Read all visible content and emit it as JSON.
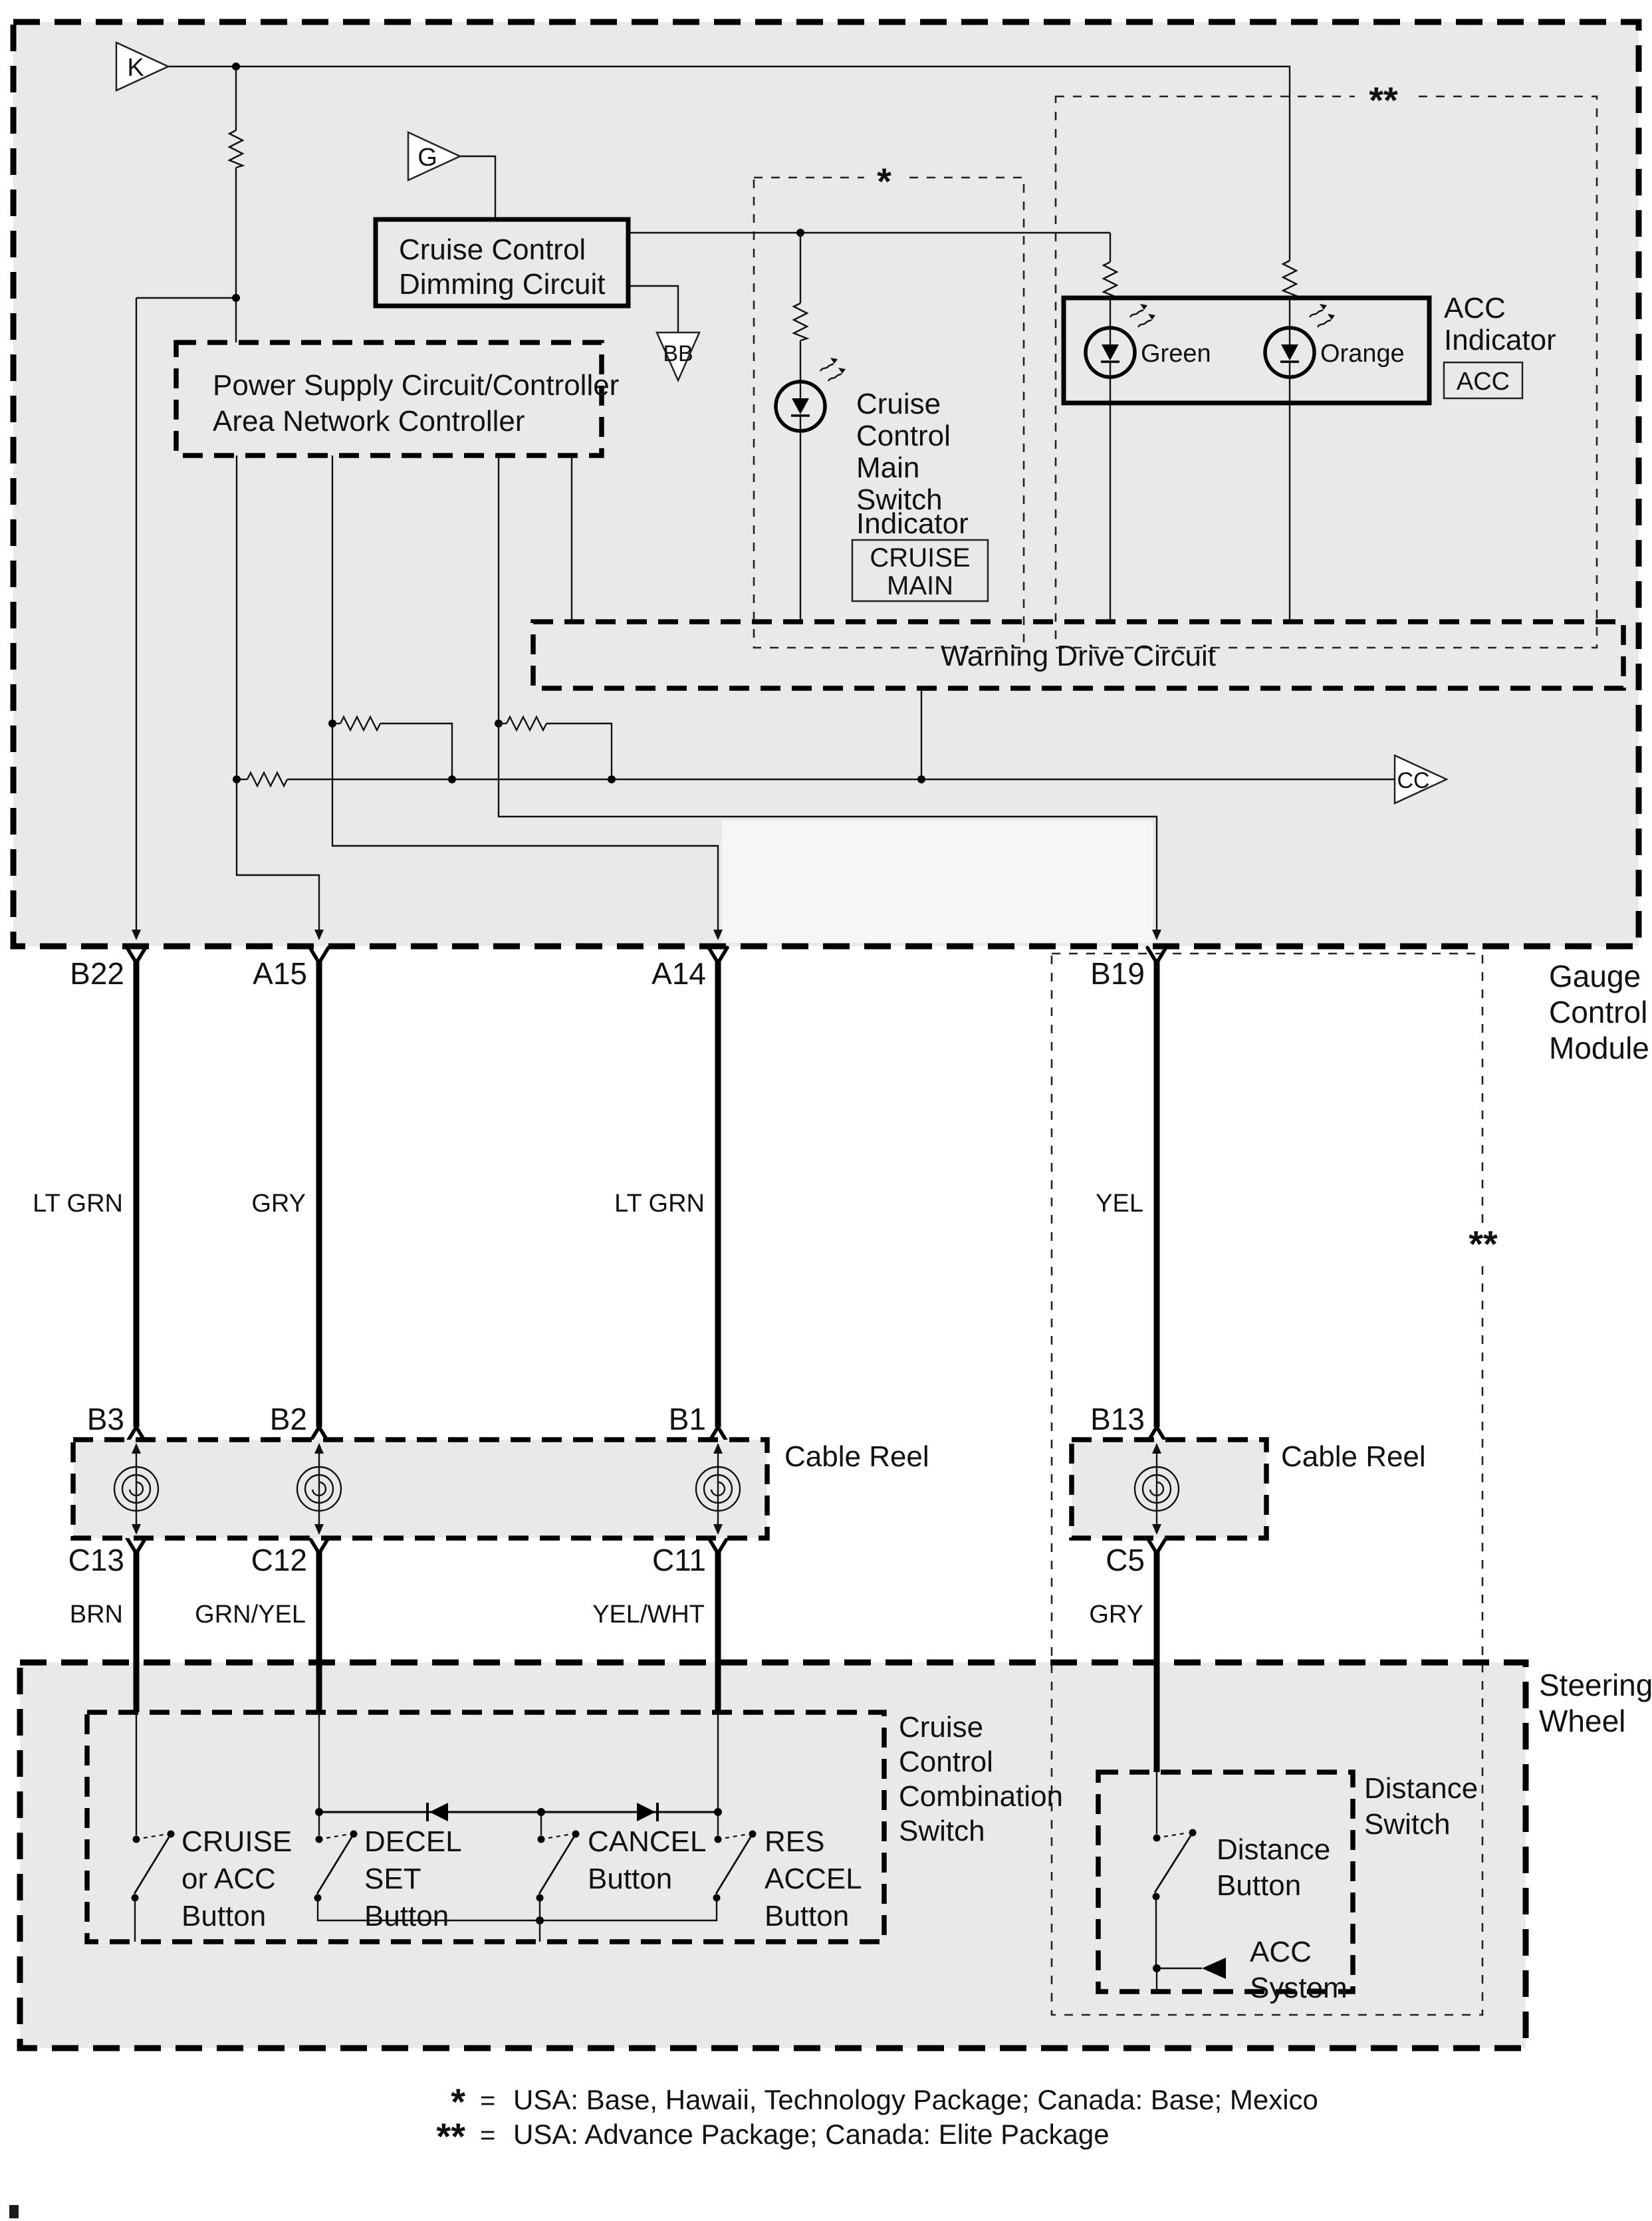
{
  "colors": {
    "module_fill": "#e9e9e9",
    "line": "#111111",
    "background": "#ffffff"
  },
  "connectors": {
    "k": "K",
    "g": "G",
    "bb": "BB",
    "cc": "CC"
  },
  "gauge": {
    "label_lines": [
      "Gauge",
      "Control",
      "Module"
    ],
    "dimming_lines": [
      "Cruise Control",
      "Dimming Circuit"
    ],
    "power_lines": [
      "Power Supply Circuit/Controller",
      "Area Network Controller"
    ],
    "warning": "Warning Drive Circuit",
    "cruise_main": {
      "label_lines": [
        "Cruise",
        "Control",
        "Main",
        "Switch",
        "Indicator"
      ],
      "badge_lines": [
        "CRUISE",
        "MAIN"
      ],
      "region_mark": "*"
    },
    "acc": {
      "label_lines": [
        "ACC",
        "Indicator"
      ],
      "badge": "ACC",
      "green": "Green",
      "orange": "Orange",
      "region_mark": "**"
    }
  },
  "harness": {
    "region_mark": "**",
    "pins": [
      {
        "pin": "B22",
        "color": "LT GRN"
      },
      {
        "pin": "A15",
        "color": "GRY"
      },
      {
        "pin": "A14",
        "color": "LT GRN"
      },
      {
        "pin": "B19",
        "color": "YEL"
      }
    ]
  },
  "cable_reel": {
    "label": "Cable Reel",
    "top_pins": [
      "B3",
      "B2",
      "B1",
      "B13"
    ],
    "bottom_pins": [
      "C13",
      "C12",
      "C11",
      "C5"
    ],
    "colors": [
      "BRN",
      "GRN/YEL",
      "YEL/WHT",
      "GRY"
    ]
  },
  "steering": {
    "label_lines": [
      "Steering",
      "Wheel"
    ],
    "combo": {
      "label_lines": [
        "Cruise",
        "Control",
        "Combination",
        "Switch"
      ],
      "switches": [
        {
          "lines": [
            "CRUISE",
            "or ACC",
            "Button"
          ]
        },
        {
          "lines": [
            "DECEL",
            "SET",
            "Button"
          ]
        },
        {
          "lines": [
            "CANCEL",
            "Button"
          ]
        },
        {
          "lines": [
            "RES",
            "ACCEL",
            "Button"
          ]
        }
      ]
    },
    "distance": {
      "label_lines": [
        "Distance",
        "Switch"
      ],
      "button_lines": [
        "Distance",
        "Button"
      ],
      "acc_lines": [
        "ACC",
        "System"
      ]
    }
  },
  "footnotes": [
    {
      "mark": "*",
      "eq": "=",
      "text": "USA: Base, Hawaii, Technology Package; Canada: Base; Mexico"
    },
    {
      "mark": "**",
      "eq": "=",
      "text": "USA: Advance Package; Canada: Elite Package"
    }
  ]
}
